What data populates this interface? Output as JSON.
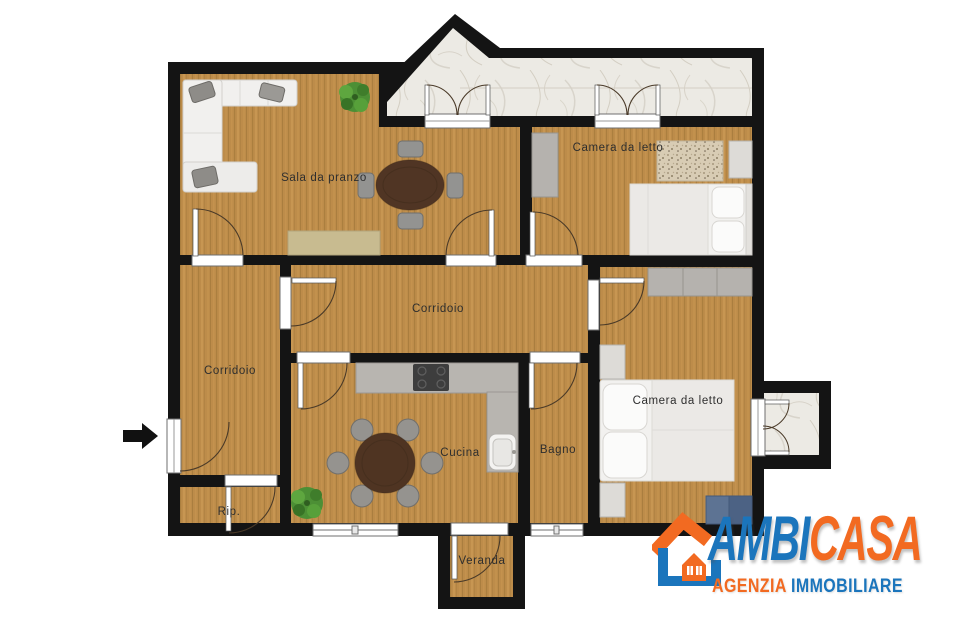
{
  "rooms": {
    "dining_room": "Sala da pranzo",
    "bedroom_top": "Camera da letto",
    "corridor_main": "Corridoio",
    "corridor_entry": "Corridoio",
    "kitchen": "Cucina",
    "bathroom": "Bagno",
    "bedroom_bottom": "Camera da letto",
    "storage": "Rip.",
    "veranda": "Veranda"
  },
  "entrance": {
    "arrow_direction": "right"
  },
  "logo": {
    "brand_blue": "AMBI",
    "brand_orange": "CASA",
    "tagline_orange": "AGENZIA",
    "tagline_blue": "IMMOBILIARE"
  },
  "colors": {
    "wall": "#141414",
    "wood_floor": "#bd8c4a",
    "marble_floor": "#eceae4",
    "counter_gray": "#b8b5b0",
    "logo_blue": "#1b75bc",
    "logo_orange": "#f26a21"
  }
}
